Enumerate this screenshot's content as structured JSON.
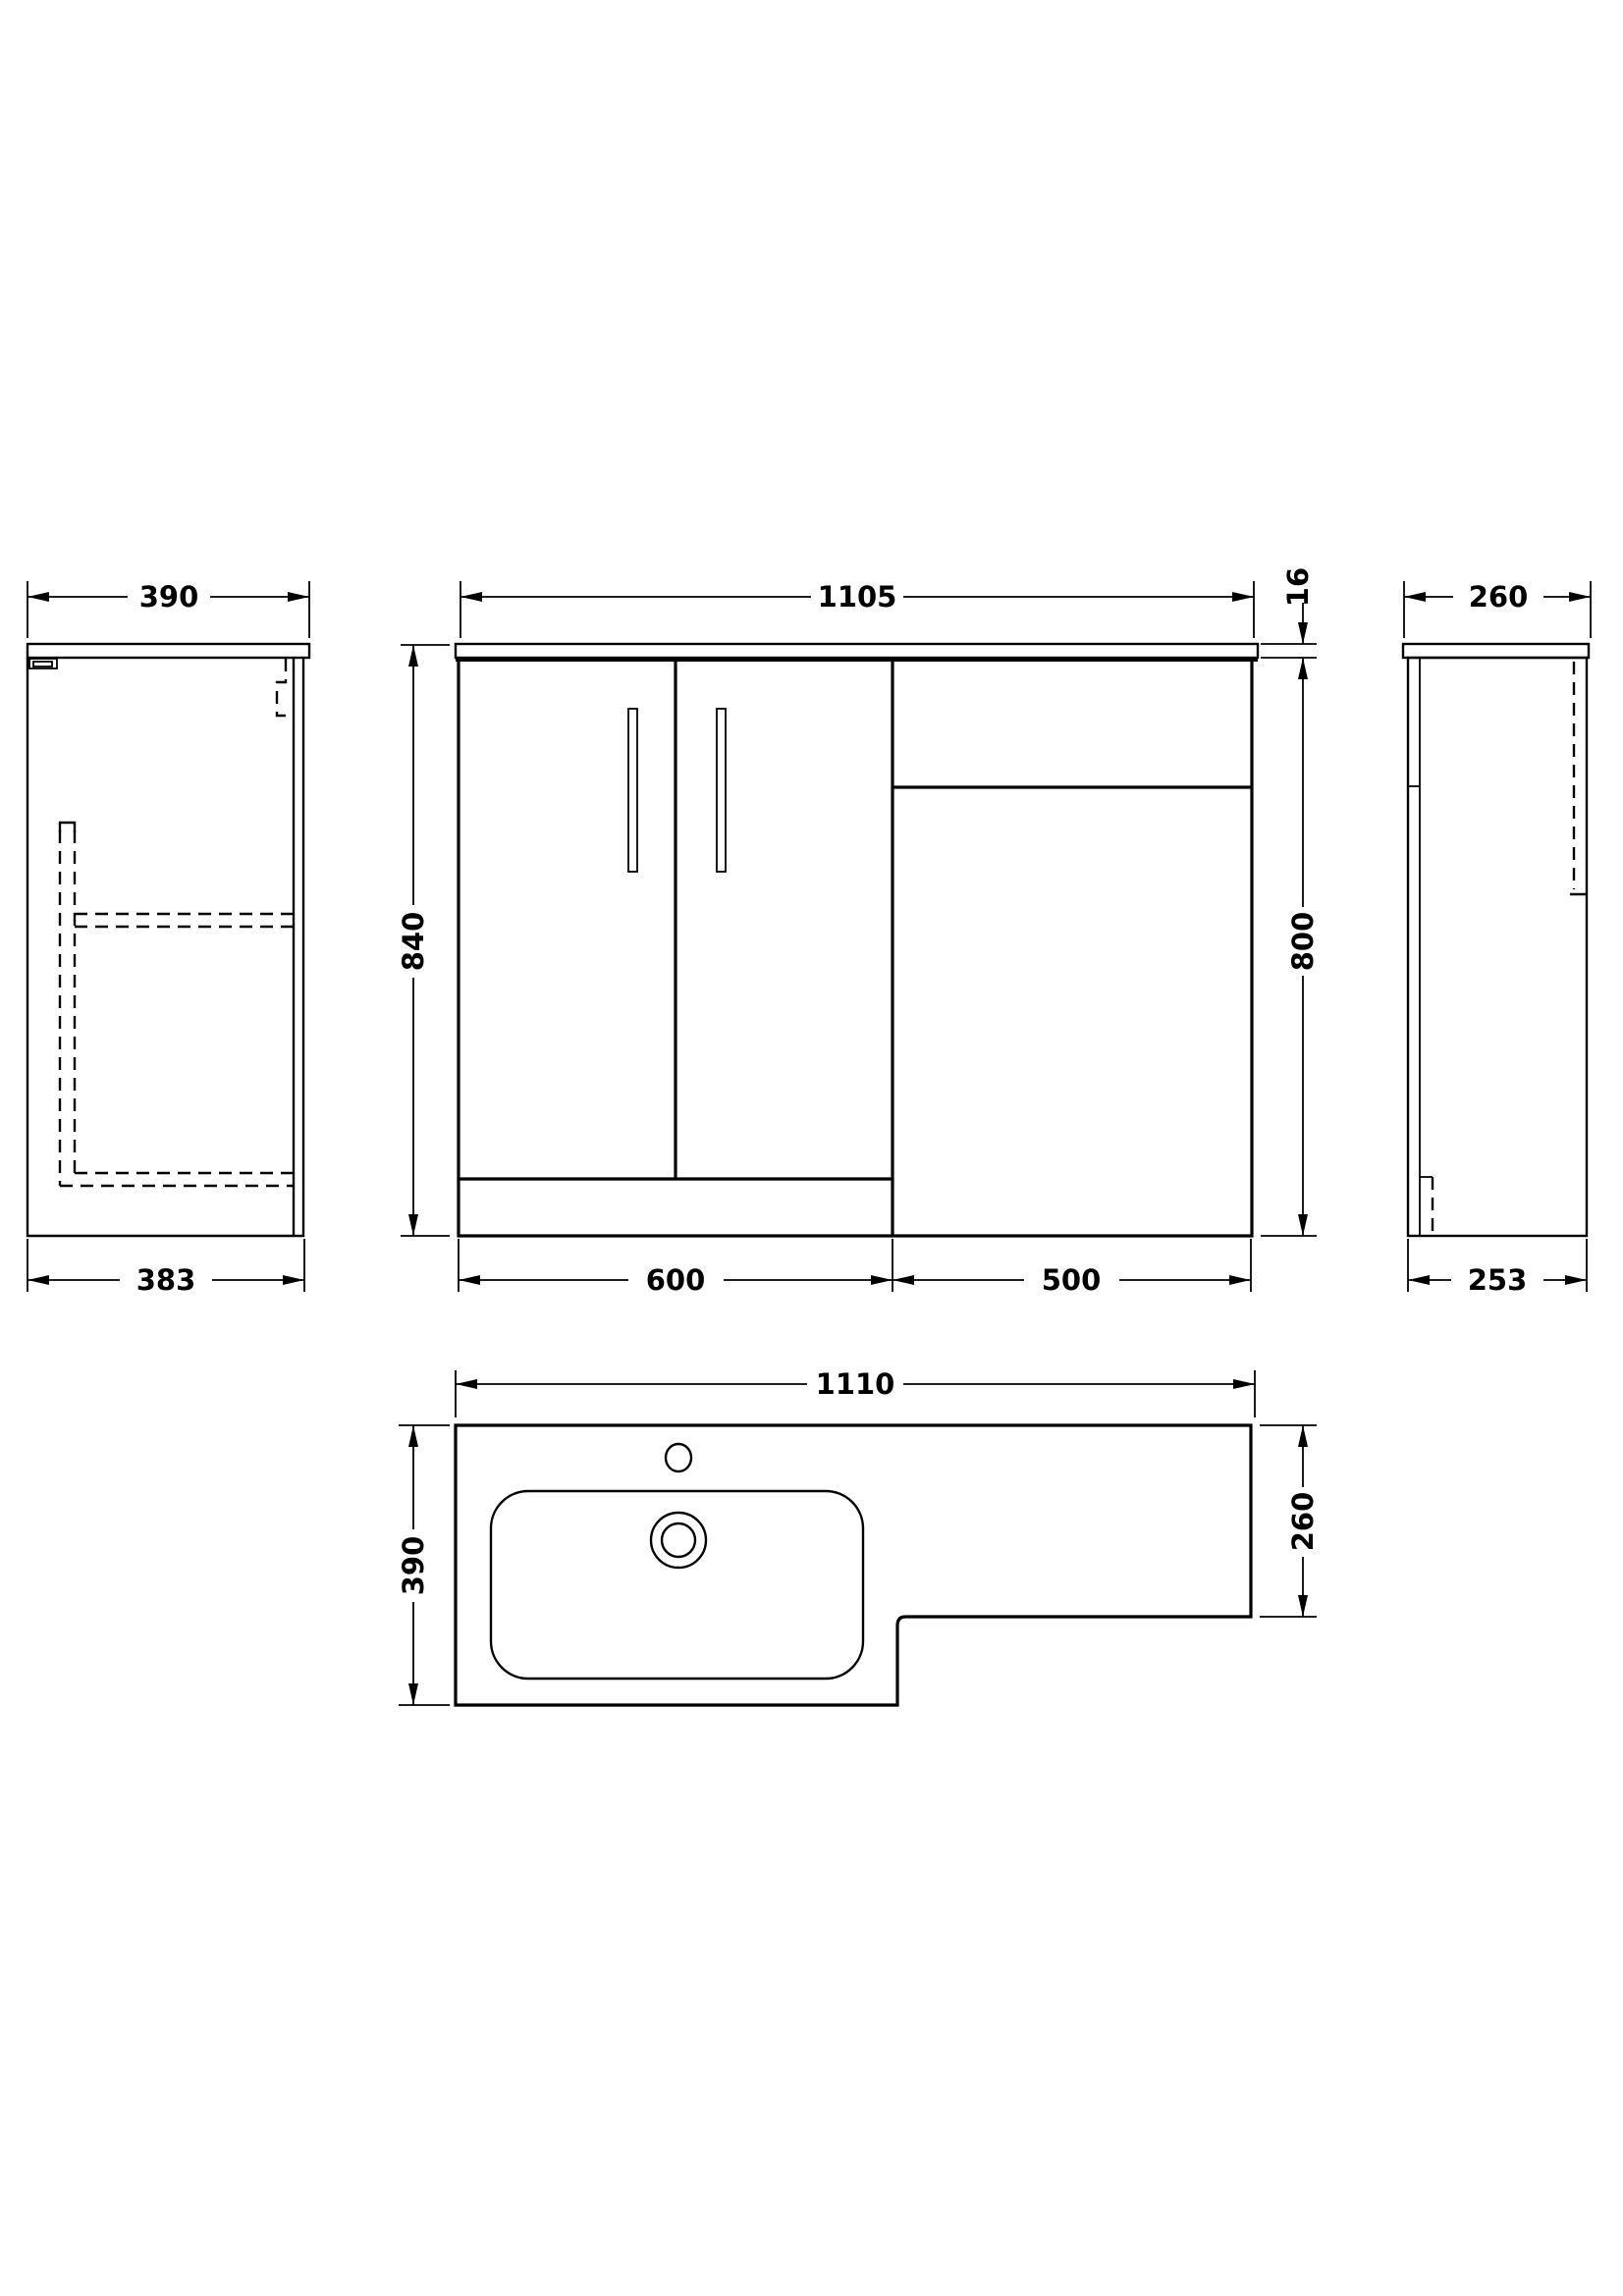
{
  "background": "#ffffff",
  "line_color": "#000000",
  "views": {
    "left_side": {
      "width_mm": "390",
      "depth_mm": "383"
    },
    "front": {
      "width_mm": "1105",
      "height_mm": "840",
      "countertop_thickness_mm": "16",
      "carcass_height_mm": "800",
      "vanity_width_mm": "600",
      "wc_unit_width_mm": "500"
    },
    "right_side": {
      "width_mm": "260",
      "depth_mm": "253"
    },
    "plan": {
      "width_mm": "1110",
      "depth_mm": "390",
      "wc_top_depth_mm": "260"
    }
  }
}
